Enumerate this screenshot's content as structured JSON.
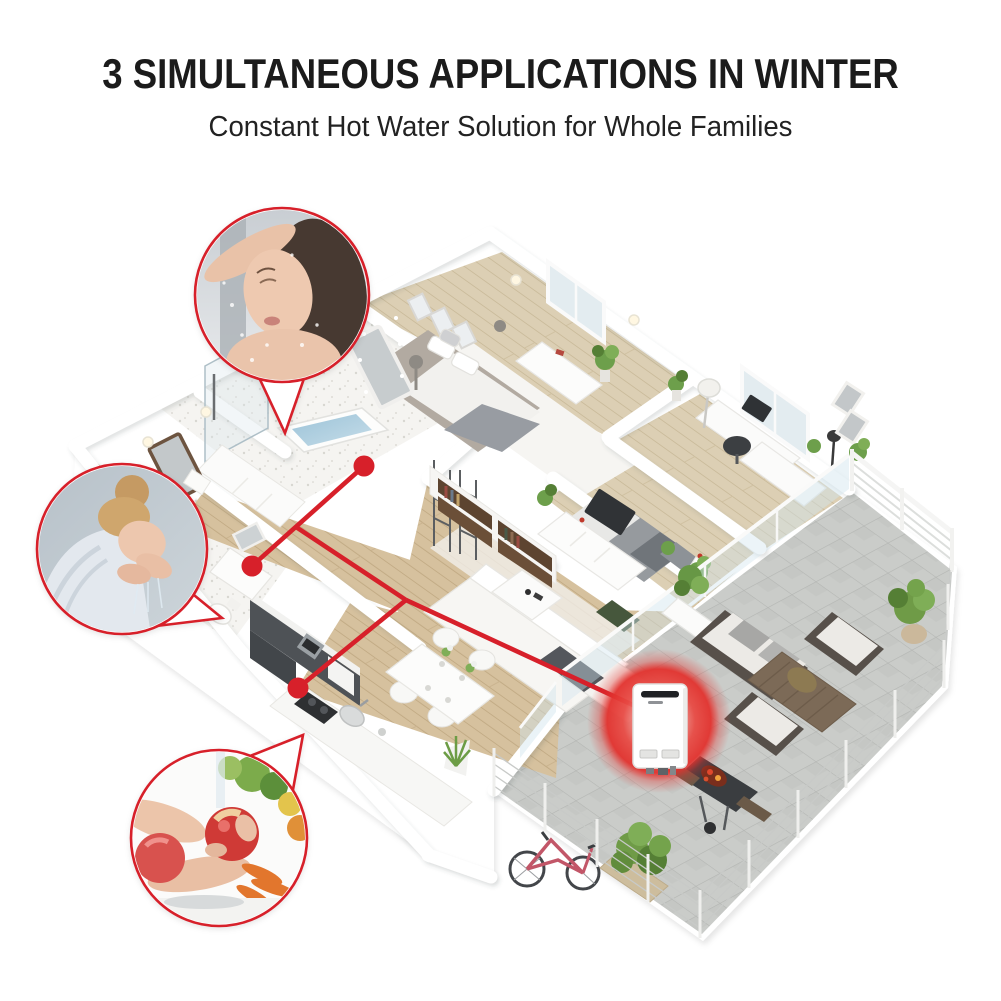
{
  "header": {
    "title": "3 SIMULTANEOUS APPLICATIONS IN WINTER",
    "subtitle": "Constant Hot Water Solution for Whole Families"
  },
  "callouts": [
    {
      "id": "shower",
      "photo": "woman-showering-photo"
    },
    {
      "id": "face-washing",
      "photo": "woman-washing-face-photo"
    },
    {
      "id": "fruit-washing",
      "photo": "hands-washing-fruit-photo"
    }
  ],
  "fixtures": [
    "bathtub-shower-point",
    "bathroom-sink-point",
    "kitchen-sink-point"
  ],
  "heater": {
    "id": "tankless-gas-water-heater"
  },
  "colors": {
    "accent_red": "#d7202a",
    "glow_red": "#e2322e",
    "title_text": "#1b1b1b",
    "wood": "#d6c19e",
    "wood_line": "#c2ab85",
    "bath_floor": "#f5f4f1",
    "patio_tile": "#caccc9",
    "tile_line": "#b4b6b3",
    "wall": "#ffffff",
    "kitchen_dark": "#4e5256",
    "plant_green": "#6c9c45",
    "water_blue": "#a9cadd"
  }
}
